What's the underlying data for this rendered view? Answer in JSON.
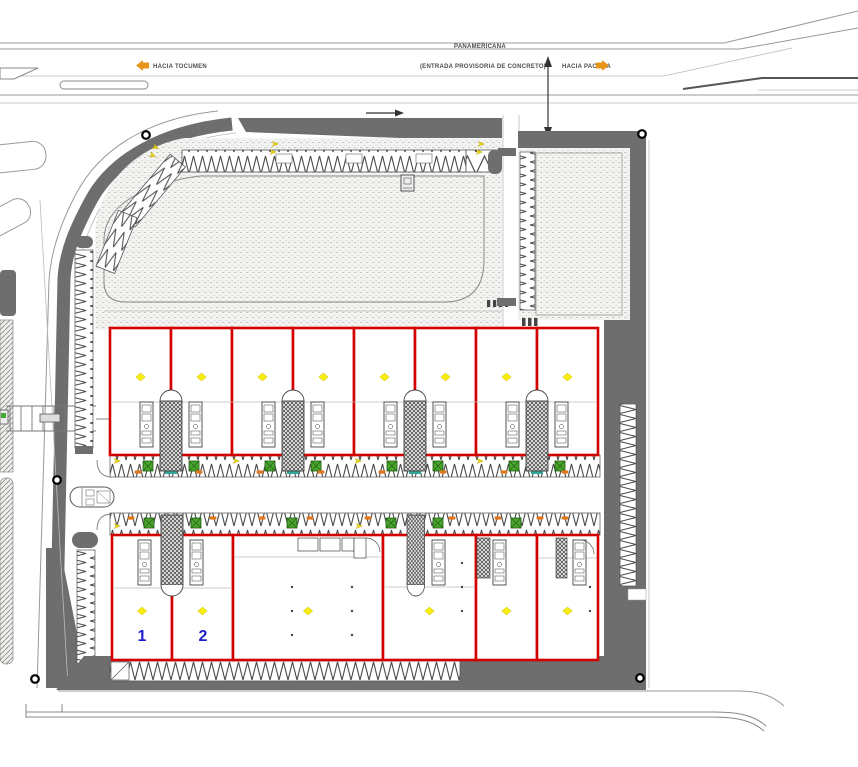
{
  "plan": {
    "highway": {
      "name": "PANAMERICANA",
      "subtitle": "(ENTRADA PROVISORIA DE CONCRETO)",
      "direction_west": "HACIA TOCUMEN",
      "direction_east": "HACIA PACORA"
    },
    "units": {
      "labels": [
        "1",
        "2"
      ]
    },
    "icons": {
      "direction_arrow_west": "◄",
      "direction_arrow_east": "►",
      "entrance_arrow": "↕",
      "flow_arrow": "→",
      "survey_marker": "○",
      "unit_marker": "◆"
    },
    "colors": {
      "unit_outline": "#d40000",
      "unit_marker": "#f6ec0f",
      "unit_label": "#1c1cc8",
      "road": "#6e6e6e",
      "direction_arrow": "#e8941a",
      "tree": "#49a32c",
      "shrub": "#e0771b",
      "core": "#2fa898"
    }
  }
}
